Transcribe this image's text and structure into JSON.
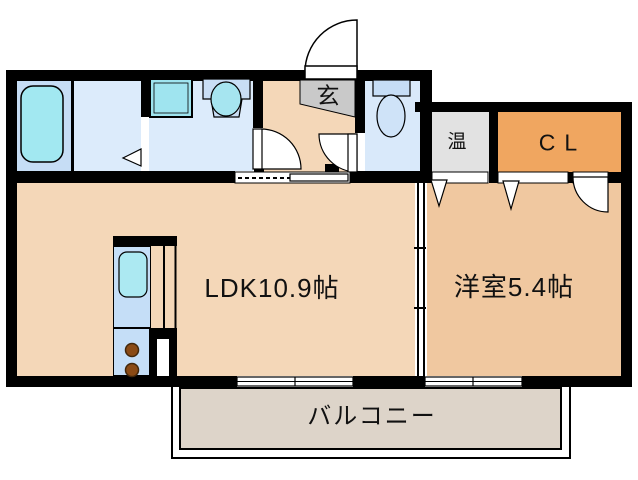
{
  "floor_plan": {
    "labels": {
      "ldk": "LDK10.9帖",
      "bedroom": "洋室5.4帖",
      "balcony": "バルコニー",
      "entrance": "玄",
      "water_heater": "温",
      "closet": "CL"
    },
    "fixtures": [
      "bathtub",
      "washing-machine-pan",
      "vanity-basin",
      "toilet",
      "kitchen-sink",
      "stove-burners",
      "refrigerator-space"
    ],
    "colors": {
      "wall": "#000000",
      "ldk_floor": "#f4d7b8",
      "bedroom_floor": "#f0c8a0",
      "closet": "#f0a660",
      "water_heater_room": "#e2e2e2",
      "bathroom": "#c6ddf5",
      "washroom": "#dcebfb",
      "toilet_room": "#d9e9fa",
      "fixture_cyan": "#a2e6f0",
      "kitchen_counter": "#c5def7",
      "balcony_floor": "#ddd4c9",
      "entry_step": "#c9c9c9",
      "burner": "#8a4a15"
    }
  }
}
